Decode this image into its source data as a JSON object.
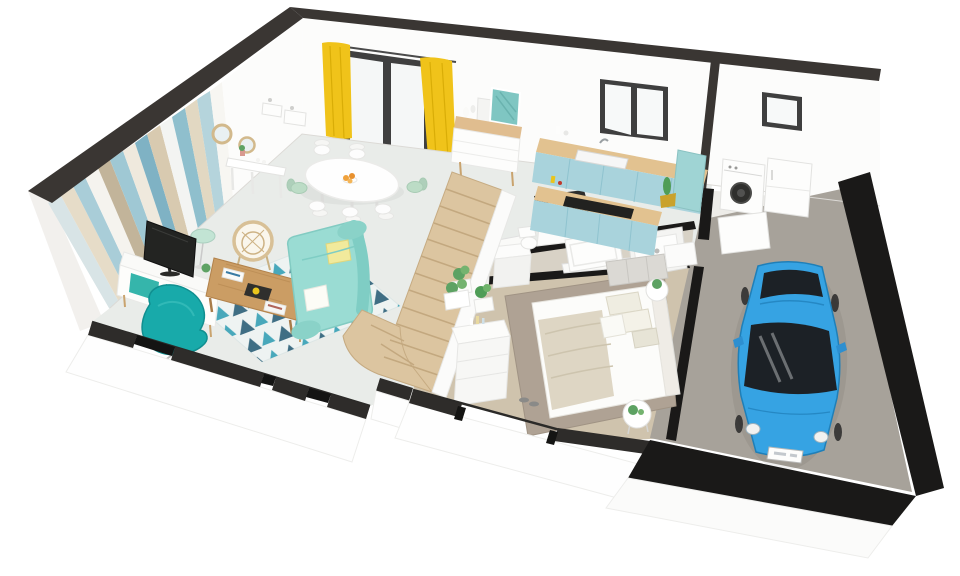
{
  "scene": {
    "type": "3d-floorplan-cutaway-render",
    "view": "aerial-perspective",
    "background": "#ffffff",
    "storeys_shown": 1,
    "visible_text": "none",
    "license_plate": {
      "visible": true,
      "legible": false
    }
  },
  "palette": {
    "wall_cut_top": "#3a3633",
    "wall_cut_top_right": "#423e3a",
    "wall_cut_black": "#1a1918",
    "wall_white": "#fcfcfb",
    "floor_living": "#e9ece9",
    "floor_bathroom": "#d8d2c6",
    "floor_bedroom": "#cfc3ad",
    "floor_laundry": "#edece8",
    "floor_garage": "#a7a29a",
    "stairs_wood": "#dcc5a0",
    "counter_wood": "#e2c290",
    "cabinet_blue": "#a9d3dc",
    "curtain_yellow": "#f0c31a",
    "frame_dark": "#3f3f3f",
    "sofa_mint": "#9adcd3",
    "armchair_teal": "#18aaaa",
    "coffee_table_wood": "#cb9d64",
    "rug_navy": "#2b5f78",
    "rug_teal": "#36a0b5",
    "bedroom_rug": "#afa294",
    "car_blue": "#36a3e3",
    "car_glass": "#1c2126",
    "plant_green": "#5da263",
    "artwork_teal": "#7fc6c2",
    "chair_mint": "#bcdcc6"
  },
  "chevron_wall": {
    "stripe_colors": [
      "#d8e4e6",
      "#e6dcc8",
      "#a9cdd8",
      "#f5f3ee",
      "#c2b49a",
      "#9fc8d4",
      "#efe9dd",
      "#7fb2c4",
      "#d8cab0",
      "#f3f4f2",
      "#8fbfcd",
      "#e2d8c2",
      "#b5d4dc",
      "#f7f6f2"
    ]
  },
  "rooms": [
    {
      "name": "living-room",
      "furniture": [
        "chevron-accent-wall",
        "tv-unit",
        "tv",
        "swivel-armchair",
        "sofa",
        "coffee-table",
        "zigzag-rug",
        "rattan-chair",
        "floor-lamp",
        "console-table",
        "round-mirrors",
        "wall-shelves"
      ]
    },
    {
      "name": "dining-area",
      "furniture": [
        "oval-table",
        "dining-chairs",
        "fruit-bowl",
        "sideboard",
        "leaning-artwork",
        "glass-door-with-yellow-curtains"
      ],
      "chair_count": 7
    },
    {
      "name": "kitchen",
      "furniture": [
        "wall-counter-with-sink",
        "island-with-cooktop",
        "window",
        "tall-cabinet",
        "cactus-pot"
      ]
    },
    {
      "name": "bathroom",
      "furniture": [
        "vanity-sink",
        "bathtub",
        "shower-tray",
        "toilet",
        "sliding-door"
      ]
    },
    {
      "name": "hallway",
      "furniture": [
        "staircase",
        "storage-closets"
      ],
      "stair_tread_count": 12
    },
    {
      "name": "bedroom",
      "furniture": [
        "double-bed",
        "pillows",
        "throw-blanket",
        "bedside-tables",
        "dresser",
        "wardrobe-units",
        "planter",
        "rug",
        "slippers"
      ],
      "pillow_count": 5
    },
    {
      "name": "garage",
      "furniture": [
        "compact-car",
        "washing-machine",
        "tall-appliance",
        "small-window",
        "service-door"
      ]
    }
  ]
}
